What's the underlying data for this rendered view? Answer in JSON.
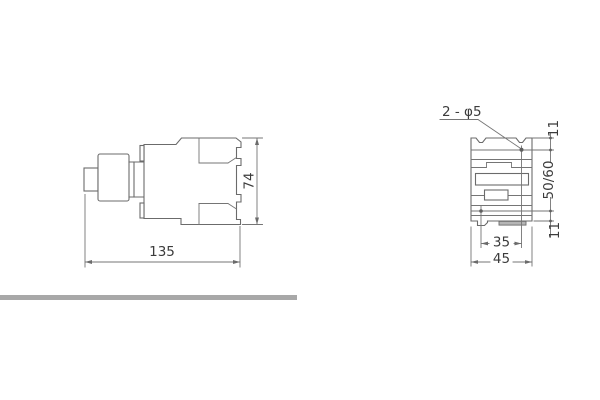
{
  "drawing": {
    "colors": {
      "background": "#ffffff",
      "line": "#6b6b6b",
      "text": "#3c3c3c",
      "divider_bar": "#a8a8a8",
      "clip_fill": "#b5b5b5"
    },
    "side_view": {
      "width_label": "135",
      "height_label": "74"
    },
    "front_view": {
      "holes_label": "2 - φ5",
      "top_offset_label": "11",
      "row_spacing_label": "50/60",
      "bottom_offset_label": "11",
      "hole_spacing_label": "35",
      "width_label": "45"
    }
  }
}
